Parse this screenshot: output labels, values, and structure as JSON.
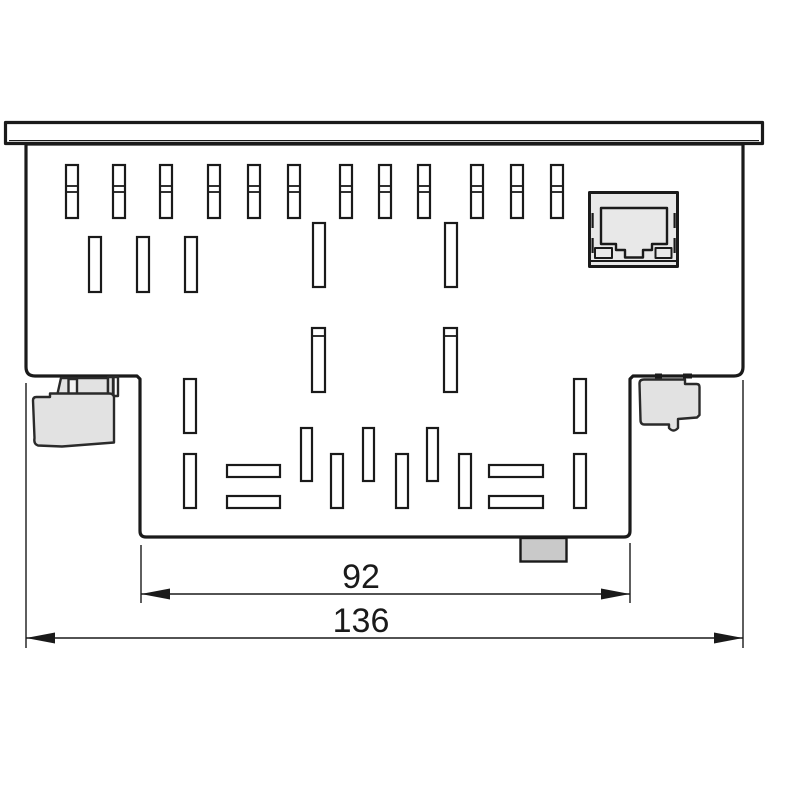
{
  "drawing": {
    "kind": "technical-dimension-drawing",
    "view": "device rear view with ventilation slots, ethernet port and connectors"
  },
  "colors": {
    "line": "#1a1a1a",
    "body_fill": "#ffffff",
    "connector_fill": "#e2e2e2",
    "port_fill": "#e8e8e8",
    "tab_fill": "#c9c9c9"
  },
  "dimensions": {
    "inner": {
      "value": "92"
    },
    "outer": {
      "value": "136"
    }
  },
  "components": {
    "flange": "mounting-flange",
    "body": "device-body",
    "ethernet_port": "rj45-ethernet-port",
    "left_connector": "connector-left",
    "right_connector": "connector-right",
    "bottom_tab": "bottom-tab"
  },
  "vents": {
    "rows": [
      {
        "name": "top-row-dual-slots",
        "y": 165,
        "w": 12,
        "h": 53,
        "dividers": [
          21,
          27
        ],
        "xs": [
          66,
          113,
          160,
          208,
          248,
          288,
          340,
          379,
          418,
          471,
          511,
          551
        ]
      },
      {
        "name": "second-row-slots",
        "y": 237,
        "w": 12,
        "h": 55,
        "dividers": [],
        "xs": [
          89,
          137,
          185
        ]
      },
      {
        "name": "center-upper-slots",
        "y": 223,
        "w": 12,
        "h": 64,
        "dividers": [],
        "xs": [
          313,
          445
        ]
      },
      {
        "name": "center-mid-slots",
        "y": 328,
        "w": 13,
        "h": 64,
        "dividers": [
          8
        ],
        "xs": [
          312,
          444
        ]
      },
      {
        "name": "lower-top-slots",
        "y": 379,
        "w": 12,
        "h": 54,
        "dividers": [],
        "xs": [
          184,
          574
        ]
      },
      {
        "name": "lower-upper-band-slots",
        "y": 428,
        "w": 11,
        "h": 53,
        "dividers": [],
        "xs": [
          301,
          363,
          427
        ]
      },
      {
        "name": "lower-lower-band-slots",
        "y": 454,
        "w": 12,
        "h": 54,
        "dividers": [],
        "xs": [
          184,
          331,
          396,
          459,
          574
        ]
      }
    ],
    "bars": [
      {
        "x": 227,
        "y": 465,
        "w": 53,
        "h": 12
      },
      {
        "x": 227,
        "y": 496,
        "w": 53,
        "h": 12
      },
      {
        "x": 489,
        "y": 465,
        "w": 54,
        "h": 12
      },
      {
        "x": 489,
        "y": 496,
        "w": 54,
        "h": 12
      }
    ]
  }
}
